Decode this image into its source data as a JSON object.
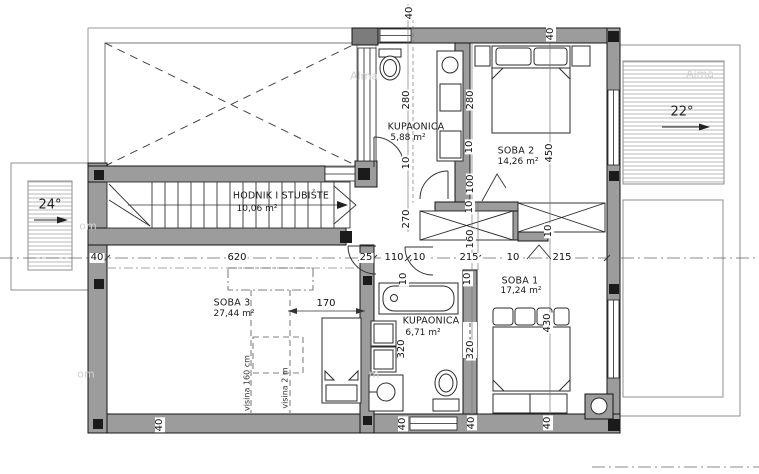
{
  "plan": {
    "roof_slope_left": "24°",
    "roof_slope_right": "22°",
    "rooms": [
      {
        "name": "HODNIK I STUBIŠTE",
        "area": "10,06 m²",
        "nx": 281,
        "ny": 196,
        "ax": 257,
        "ay": 209
      },
      {
        "name": "KUPAONICA",
        "area": "5,88 m²",
        "nx": 416,
        "ny": 127,
        "ax": 408,
        "ay": 138
      },
      {
        "name": "SOBA 2",
        "area": "14,26 m²",
        "nx": 516,
        "ny": 151,
        "ax": 518,
        "ay": 162
      },
      {
        "name": "SOBA 1",
        "area": "17,24 m²",
        "nx": 520,
        "ny": 281,
        "ax": 521,
        "ay": 291
      },
      {
        "name": "KUPAONICA",
        "area": "6,71 m²",
        "nx": 431,
        "ny": 321,
        "ax": 423,
        "ay": 333
      },
      {
        "name": "SOBA 3",
        "area": "27,44 m²",
        "nx": 232,
        "ny": 303,
        "ax": 234,
        "ay": 314
      }
    ],
    "height_labels": [
      {
        "text": "visina 160 cm",
        "x": 247,
        "y": 383
      },
      {
        "text": "visina 2 m",
        "x": 285,
        "y": 388
      }
    ]
  },
  "dimension_labels": [
    {
      "text": "40",
      "x": 97,
      "y": 258,
      "rot": 0
    },
    {
      "text": "620",
      "x": 237,
      "y": 258,
      "rot": 0
    },
    {
      "text": "25",
      "x": 366,
      "y": 258,
      "rot": 0
    },
    {
      "text": "110",
      "x": 394,
      "y": 258,
      "rot": 0
    },
    {
      "text": "10",
      "x": 419,
      "y": 258,
      "rot": 0
    },
    {
      "text": "215",
      "x": 469,
      "y": 258,
      "rot": 0
    },
    {
      "text": "10",
      "x": 513,
      "y": 258,
      "rot": 0
    },
    {
      "text": "215",
      "x": 562,
      "y": 258,
      "rot": 0
    },
    {
      "text": "170",
      "x": 326,
      "y": 304,
      "rot": 0
    },
    {
      "text": "40",
      "x": 410,
      "y": 13,
      "rot": -90
    },
    {
      "text": "280",
      "x": 407,
      "y": 100,
      "rot": -90
    },
    {
      "text": "10",
      "x": 407,
      "y": 163,
      "rot": -90
    },
    {
      "text": "270",
      "x": 407,
      "y": 219,
      "rot": -90
    },
    {
      "text": "10",
      "x": 404,
      "y": 279,
      "rot": -90
    },
    {
      "text": "320",
      "x": 402,
      "y": 349,
      "rot": -90
    },
    {
      "text": "40",
      "x": 403,
      "y": 424,
      "rot": -90
    },
    {
      "text": "280",
      "x": 471,
      "y": 100,
      "rot": -90
    },
    {
      "text": "10",
      "x": 470,
      "y": 147,
      "rot": -90
    },
    {
      "text": "100",
      "x": 471,
      "y": 184,
      "rot": -90
    },
    {
      "text": "10",
      "x": 470,
      "y": 207,
      "rot": -90
    },
    {
      "text": "160",
      "x": 471,
      "y": 239,
      "rot": -90
    },
    {
      "text": "10",
      "x": 468,
      "y": 279,
      "rot": -90
    },
    {
      "text": "320",
      "x": 471,
      "y": 350,
      "rot": -90
    },
    {
      "text": "40",
      "x": 472,
      "y": 423,
      "rot": -90
    },
    {
      "text": "40",
      "x": 551,
      "y": 34,
      "rot": -90
    },
    {
      "text": "450",
      "x": 550,
      "y": 153,
      "rot": -90
    },
    {
      "text": "10",
      "x": 549,
      "y": 231,
      "rot": -90
    },
    {
      "text": "430",
      "x": 548,
      "y": 323,
      "rot": -90
    },
    {
      "text": "40",
      "x": 548,
      "y": 423,
      "rot": -90
    },
    {
      "text": "40",
      "x": 160,
      "y": 425,
      "rot": -90
    }
  ],
  "watermarks": [
    {
      "text": "om",
      "x": 88,
      "y": 226
    },
    {
      "text": "Alma",
      "x": 364,
      "y": 76
    },
    {
      "text": "om",
      "x": 86,
      "y": 374
    },
    {
      "text": "m",
      "x": 374,
      "y": 374
    },
    {
      "text": "Alma",
      "x": 700,
      "y": 74
    }
  ],
  "colors": {
    "wall": "#9c9c9c",
    "post": "#1b1b1b",
    "line": "#222222",
    "hatch": "#b8b8b8"
  }
}
